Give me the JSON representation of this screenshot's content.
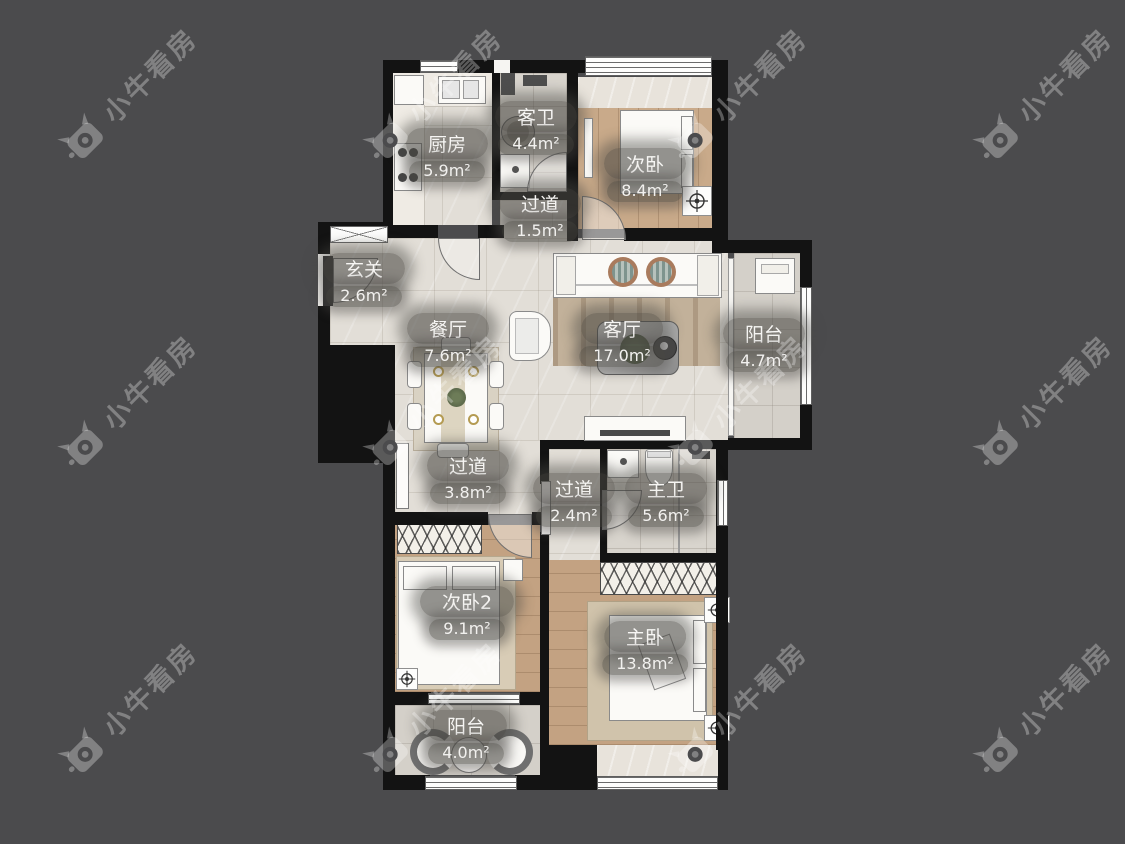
{
  "watermark": {
    "text": "小牛看房"
  },
  "colors": {
    "background": "#4b4b4d",
    "wall": "#131313",
    "tile_floor": "#e2ded7",
    "wood_floor": "#c3a282",
    "label_pill": "rgba(72,70,66,0.58)"
  },
  "rooms": [
    {
      "id": "kitchen",
      "name": "厨房",
      "area": "5.9m²"
    },
    {
      "id": "guest-bath",
      "name": "客卫",
      "area": "4.4m²"
    },
    {
      "id": "hallway-top",
      "name": "过道",
      "area": "1.5m²"
    },
    {
      "id": "bedroom-2",
      "name": "次卧",
      "area": "8.4m²"
    },
    {
      "id": "entrance",
      "name": "玄关",
      "area": "2.6m²"
    },
    {
      "id": "dining",
      "name": "餐厅",
      "area": "7.6m²"
    },
    {
      "id": "living",
      "name": "客厅",
      "area": "17.0m²"
    },
    {
      "id": "balcony-east",
      "name": "阳台",
      "area": "4.7m²"
    },
    {
      "id": "hallway-mid",
      "name": "过道",
      "area": "3.8m²"
    },
    {
      "id": "hallway-small",
      "name": "过道",
      "area": "2.4m²"
    },
    {
      "id": "master-bath",
      "name": "主卫",
      "area": "5.6m²"
    },
    {
      "id": "bedroom-3",
      "name": "次卧2",
      "area": "9.1m²"
    },
    {
      "id": "master-bedroom",
      "name": "主卧",
      "area": "13.8m²"
    },
    {
      "id": "balcony-south",
      "name": "阳台",
      "area": "4.0m²"
    }
  ]
}
